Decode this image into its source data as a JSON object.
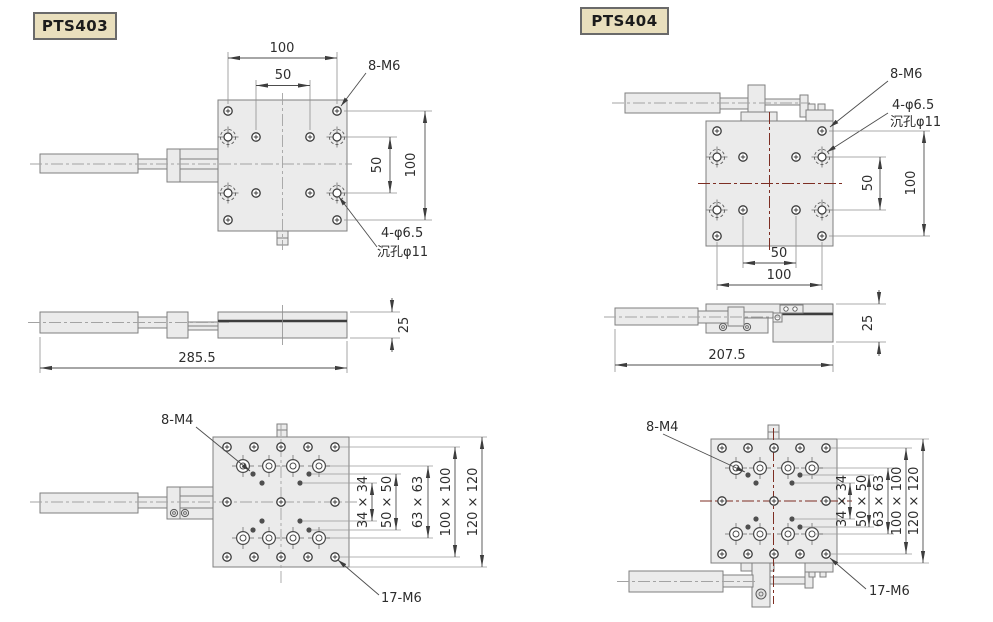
{
  "colors": {
    "background": "#ffffff",
    "badge_bg": "#e9dfbd",
    "badge_border": "#6a6a6a",
    "part_fill": "#ebebeb",
    "part_line": "#7f7f7f",
    "dim_line": "#4d4d4d",
    "centerline_gray": "#a3a3a3",
    "centerline_red": "#7d2e23"
  },
  "products": [
    {
      "model": "PTS403",
      "top_view": {
        "dim_top_outer": "100",
        "dim_top_inner": "50",
        "thread_label": "8-M6",
        "dim_right_inner": "50",
        "dim_right_outer": "100",
        "counterbore_label": "4-φ6.5",
        "counterbore_label2": "沉孔φ11"
      },
      "side_view": {
        "dim_length": "285.5",
        "dim_height": "25"
      },
      "bottom_view": {
        "thread_label_m4": "8-M4",
        "dim_34": "34 × 34",
        "dim_50": "50 × 50",
        "dim_63": "63 × 63",
        "dim_100": "100 × 100",
        "dim_120": "120 × 120",
        "thread_label_m6": "17-M6"
      }
    },
    {
      "model": "PTS404",
      "top_view": {
        "thread_label": "8-M6",
        "counterbore_label": "4-φ6.5",
        "counterbore_label2": "沉孔φ11",
        "dim_right_inner": "50",
        "dim_right_outer": "100",
        "dim_bottom_inner": "50",
        "dim_bottom_outer": "100"
      },
      "side_view": {
        "dim_length": "207.5",
        "dim_height": "25"
      },
      "bottom_view": {
        "thread_label_m4": "8-M4",
        "dim_34": "34 × 34",
        "dim_50": "50 × 50",
        "dim_63": "63 × 63",
        "dim_100": "100 × 100",
        "dim_120": "120 × 120",
        "thread_label_m6": "17-M6"
      }
    }
  ]
}
